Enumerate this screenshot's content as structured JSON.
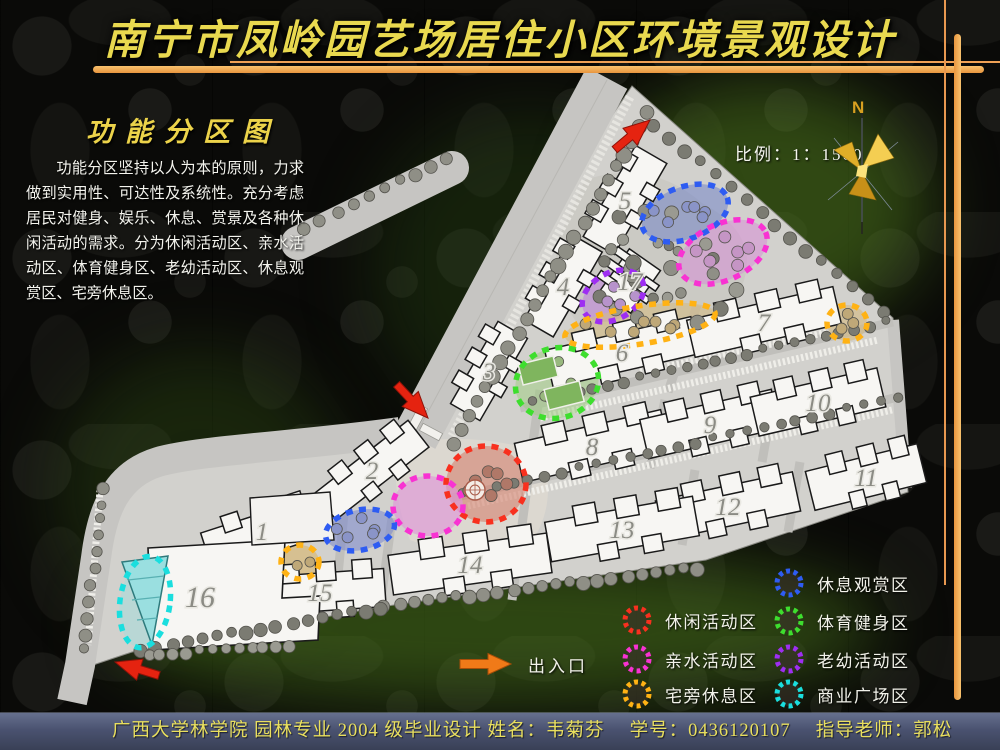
{
  "header": {
    "title": "南宁市凤岭园艺场居住小区环境景观设计"
  },
  "section": {
    "heading": "功能分区图",
    "paragraph": "功能分区坚持以人为本的原则，力求做到实用性、可达性及系统性。充分考虑居民对健身、娱乐、休息、赏景及各种休闲活动的需求。分为休闲活动区、亲水活动区、体育健身区、老幼活动区、休息观赏区、宅旁休息区。"
  },
  "map": {
    "scale_label": "比例：1：1500",
    "north_label": "N",
    "building_numbers": [
      "1",
      "2",
      "3",
      "4",
      "5",
      "6",
      "7",
      "8",
      "9",
      "10",
      "11",
      "12",
      "13",
      "14",
      "15",
      "16",
      "17"
    ]
  },
  "legend": {
    "entrance_label": "出入口",
    "entrance_arrow_color": "#f07a18",
    "zones_left": [
      {
        "label": "休闲活动区",
        "color": "#f8301e"
      },
      {
        "label": "亲水活动区",
        "color": "#f832d2"
      },
      {
        "label": "宅旁休息区",
        "color": "#ffb214"
      }
    ],
    "zones_right": [
      {
        "label": "休息观赏区",
        "color": "#2e5cf2"
      },
      {
        "label": "体育健身区",
        "color": "#3ede2e"
      },
      {
        "label": "老幼活动区",
        "color": "#9e2ef2"
      },
      {
        "label": "商业广场区",
        "color": "#1adede"
      }
    ]
  },
  "footer": {
    "text": "广西大学林学院 园林专业 2004 级毕业设计 姓名：韦菊芬　 学号：0436120107　 指导老师：郭松"
  },
  "colors": {
    "title_gold": "#e9d94f",
    "accent_orange": "#f0a050",
    "map_exit_arrow_red": "#e52310",
    "footer_text_yellow": "#e9df5e"
  }
}
